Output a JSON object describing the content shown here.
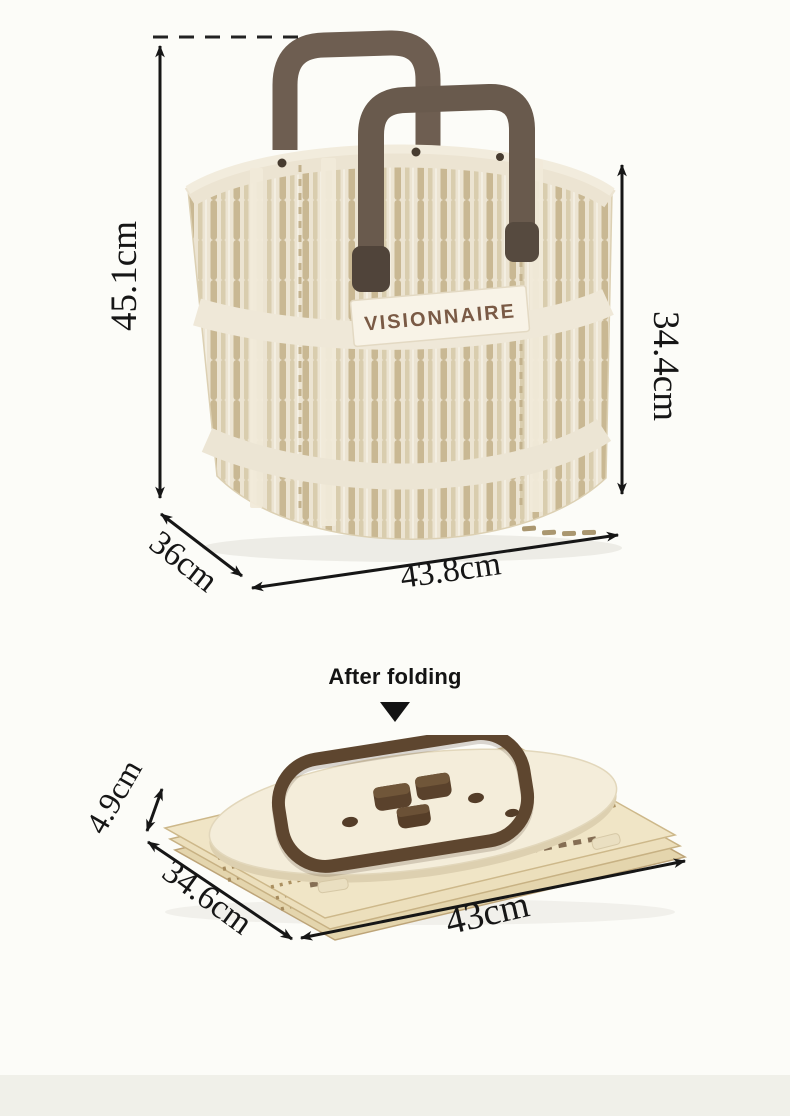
{
  "figure_assembled": {
    "brand": "VISIONNAIRE",
    "dim_total_height": "45.1cm",
    "dim_wall_height": "34.4cm",
    "dim_depth": "36cm",
    "dim_width": "43.8cm"
  },
  "divider": {
    "label": "After folding",
    "arrow_icon": "down-triangle"
  },
  "figure_folded": {
    "dim_height": "4.9cm",
    "dim_depth": "34.6cm",
    "dim_width": "43cm"
  },
  "colors": {
    "background": "#fcfcf8",
    "footer_band": "#f0f0e9",
    "basket_cream": "#ece4d2",
    "slot_tan": "#c9b893",
    "handle_brown": "#6a5b4e",
    "folded_handle_brown": "#5e462f",
    "brand_text_brown": "#7a5a45",
    "annotation_black": "#161616"
  }
}
